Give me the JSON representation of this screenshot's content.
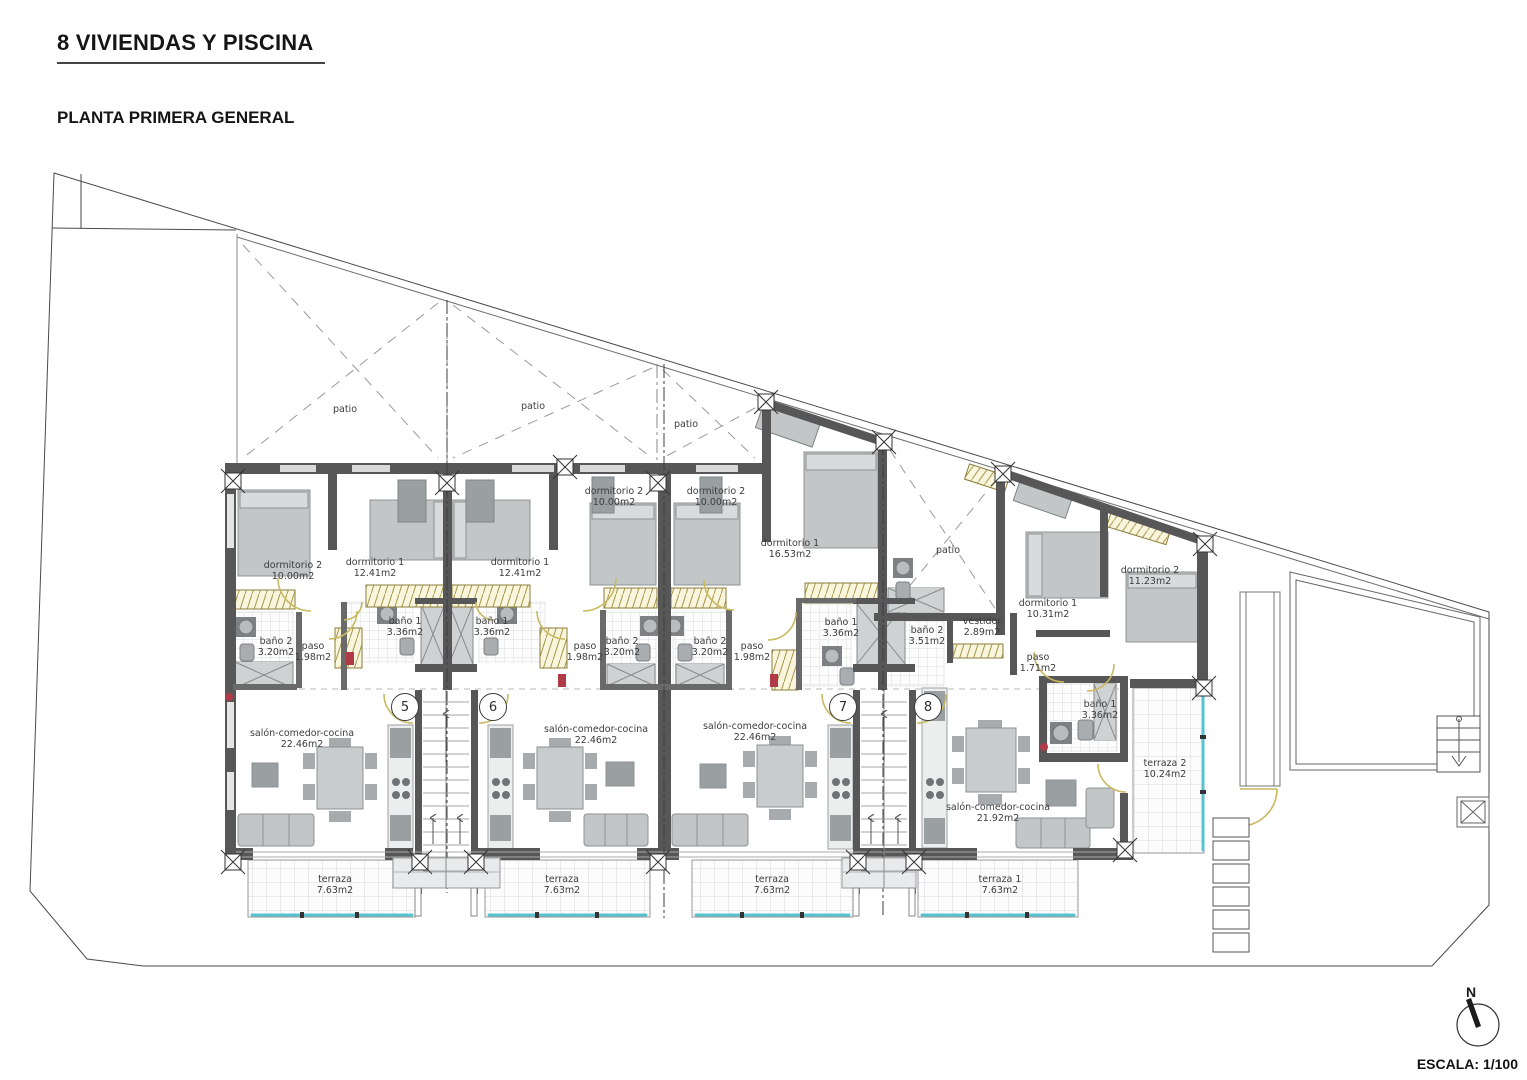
{
  "header": {
    "title": "8 VIVIENDAS Y PISCINA",
    "subtitle": "PLANTA PRIMERA GENERAL"
  },
  "legend": {
    "north": "N",
    "scale": "ESCALA: 1/100"
  },
  "colors": {
    "wall": "#575757",
    "glass_teal": "#56c3d0",
    "wardrobe_hatch": "#a5954a",
    "door_arc": "#c9b961",
    "marker_red": "#b03a48"
  },
  "unit_badges": [
    {
      "number": "5",
      "x": 405,
      "y": 707
    },
    {
      "number": "6",
      "x": 493,
      "y": 707
    },
    {
      "number": "7",
      "x": 843,
      "y": 707
    },
    {
      "number": "8",
      "x": 928,
      "y": 707
    }
  ],
  "room_labels": [
    {
      "id": "dormitorio2-u5",
      "line1": "dormitorio 2",
      "line2": "10.00m2",
      "x": 293,
      "y": 560
    },
    {
      "id": "dormitorio1-u5",
      "line1": "dormitorio 1",
      "line2": "12.41m2",
      "x": 375,
      "y": 557
    },
    {
      "id": "dormitorio1-u6",
      "line1": "dormitorio 1",
      "line2": "12.41m2",
      "x": 520,
      "y": 557
    },
    {
      "id": "dormitorio2-u6",
      "line1": "dormitorio 2",
      "line2": "10.00m2",
      "x": 614,
      "y": 486
    },
    {
      "id": "dormitorio2-u7",
      "line1": "dormitorio 2",
      "line2": "10.00m2",
      "x": 716,
      "y": 486
    },
    {
      "id": "dormitorio1-u7",
      "line1": "dormitorio 1",
      "line2": "16.53m2",
      "x": 790,
      "y": 538
    },
    {
      "id": "dormitorio1-u8",
      "line1": "dormitorio 1",
      "line2": "10.31m2",
      "x": 1048,
      "y": 598
    },
    {
      "id": "dormitorio2-u8",
      "line1": "dormitorio 2",
      "line2": "11.23m2",
      "x": 1150,
      "y": 565
    },
    {
      "id": "bano1-u5",
      "line1": "baño 1",
      "line2": "3.36m2",
      "x": 405,
      "y": 616
    },
    {
      "id": "bano1-u6",
      "line1": "baño 1",
      "line2": "3.36m2",
      "x": 492,
      "y": 616
    },
    {
      "id": "bano2-u5",
      "line1": "baño 2",
      "line2": "3.20m2",
      "x": 276,
      "y": 636
    },
    {
      "id": "bano2-u6",
      "line1": "baño 2",
      "line2": "3.20m2",
      "x": 622,
      "y": 636
    },
    {
      "id": "bano2-u7",
      "line1": "baño 2",
      "line2": "3.20m2",
      "x": 710,
      "y": 636
    },
    {
      "id": "bano1-u7",
      "line1": "baño 1",
      "line2": "3.36m2",
      "x": 841,
      "y": 617
    },
    {
      "id": "bano2-u8",
      "line1": "baño 2",
      "line2": "3.51m2",
      "x": 927,
      "y": 625
    },
    {
      "id": "vestidor-u8",
      "line1": "vestidor",
      "line2": "2.89m2",
      "x": 982,
      "y": 616
    },
    {
      "id": "bano1-u8",
      "line1": "baño 1",
      "line2": "3.36m2",
      "x": 1100,
      "y": 699
    },
    {
      "id": "paso-u5",
      "line1": "paso",
      "line2": "1.98m2",
      "x": 313,
      "y": 641
    },
    {
      "id": "paso-u6",
      "line1": "paso",
      "line2": "1.98m2",
      "x": 585,
      "y": 641
    },
    {
      "id": "paso-u7",
      "line1": "paso",
      "line2": "1.98m2",
      "x": 752,
      "y": 641
    },
    {
      "id": "paso-u8",
      "line1": "paso",
      "line2": "1.71m2",
      "x": 1038,
      "y": 652
    },
    {
      "id": "salon-u5",
      "line1": "salón-comedor-cocina",
      "line2": "22.46m2",
      "x": 302,
      "y": 728
    },
    {
      "id": "salon-u6",
      "line1": "salón-comedor-cocina",
      "line2": "22.46m2",
      "x": 596,
      "y": 724
    },
    {
      "id": "salon-u7",
      "line1": "salón-comedor-cocina",
      "line2": "22.46m2",
      "x": 755,
      "y": 721
    },
    {
      "id": "salon-u8",
      "line1": "salón-comedor-cocina",
      "line2": "21.92m2",
      "x": 998,
      "y": 802
    },
    {
      "id": "terraza-u5",
      "line1": "terraza",
      "line2": "7.63m2",
      "x": 335,
      "y": 874
    },
    {
      "id": "terraza-u6",
      "line1": "terraza",
      "line2": "7.63m2",
      "x": 562,
      "y": 874
    },
    {
      "id": "terraza-u7",
      "line1": "terraza",
      "line2": "7.63m2",
      "x": 772,
      "y": 874
    },
    {
      "id": "terraza1-u8",
      "line1": "terraza 1",
      "line2": "7.63m2",
      "x": 1000,
      "y": 874
    },
    {
      "id": "terraza2-u8",
      "line1": "terraza 2",
      "line2": "10.24m2",
      "x": 1165,
      "y": 758
    },
    {
      "id": "patio-1",
      "line1": "patio",
      "line2": "",
      "x": 345,
      "y": 404
    },
    {
      "id": "patio-2",
      "line1": "patio",
      "line2": "",
      "x": 533,
      "y": 401
    },
    {
      "id": "patio-3",
      "line1": "patio",
      "line2": "",
      "x": 686,
      "y": 419
    },
    {
      "id": "patio-4",
      "line1": "patio",
      "line2": "",
      "x": 948,
      "y": 545
    }
  ]
}
